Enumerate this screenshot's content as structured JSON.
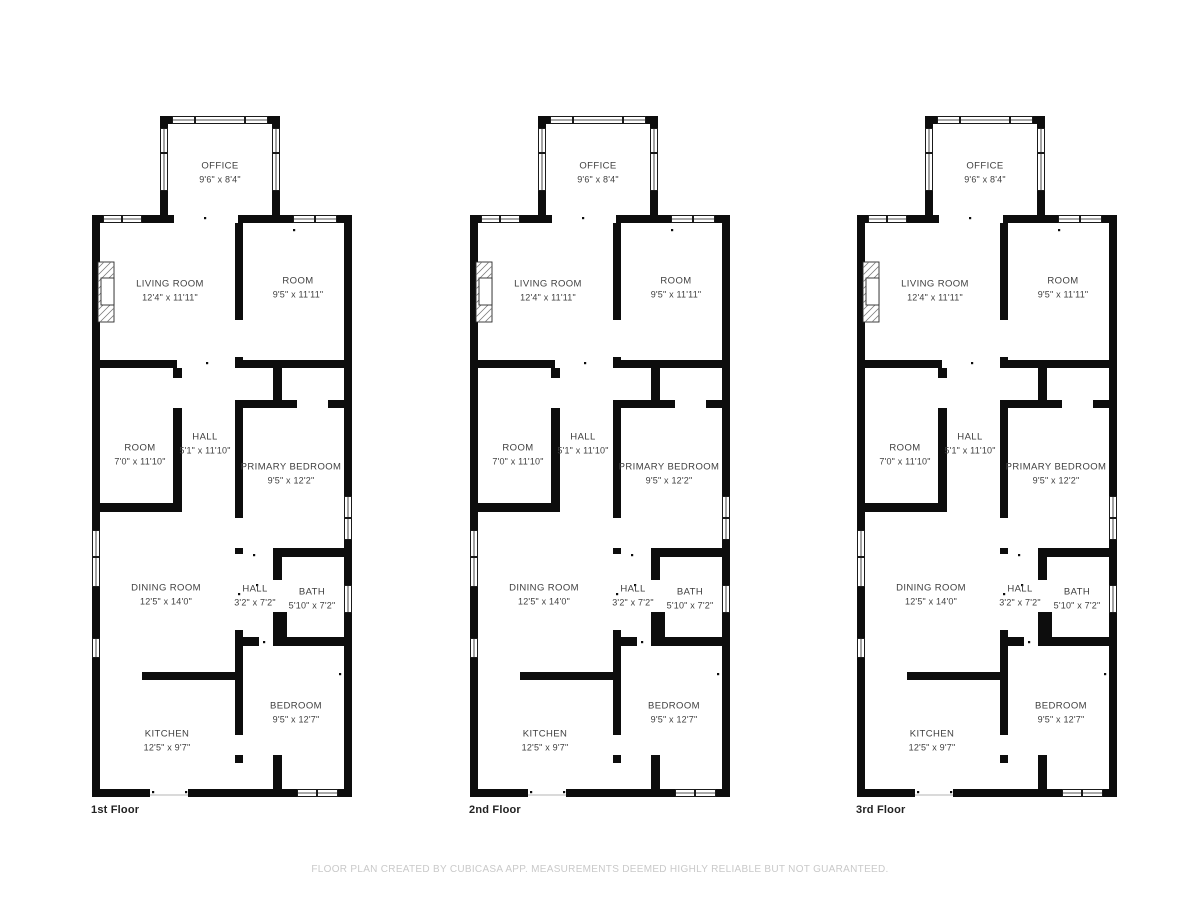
{
  "footer": {
    "disclaimer": "FLOOR PLAN CREATED BY CUBICASA APP. MEASUREMENTS DEEMED HIGHLY RELIABLE BUT NOT GUARANTEED."
  },
  "floors": [
    {
      "label": "1st Floor"
    },
    {
      "label": "2nd Floor"
    },
    {
      "label": "3rd Floor"
    }
  ],
  "rooms": {
    "office": {
      "name": "OFFICE",
      "dims": "9'6\" x 8'4\""
    },
    "living_room": {
      "name": "LIVING ROOM",
      "dims": "12'4\" x 11'11\""
    },
    "room_top": {
      "name": "ROOM",
      "dims": "9'5\" x 11'11\""
    },
    "room_mid": {
      "name": "ROOM",
      "dims": "7'0\" x 11'10\""
    },
    "hall_main": {
      "name": "HALL",
      "dims": "5'1\" x 11'10\""
    },
    "primary_bedroom": {
      "name": "PRIMARY BEDROOM",
      "dims": "9'5\" x 12'2\""
    },
    "dining_room": {
      "name": "DINING ROOM",
      "dims": "12'5\" x 14'0\""
    },
    "hall_small": {
      "name": "HALL",
      "dims": "3'2\" x 7'2\""
    },
    "bath": {
      "name": "BATH",
      "dims": "5'10\" x 7'2\""
    },
    "kitchen": {
      "name": "KITCHEN",
      "dims": "12'5\" x 9'7\""
    },
    "bedroom": {
      "name": "BEDROOM",
      "dims": "9'5\" x 12'7\""
    }
  },
  "colors": {
    "wall": "#0d0d0d",
    "room_label": "#3f3f3f",
    "floor_label": "#222222",
    "footer_text": "#c9c9c9"
  }
}
